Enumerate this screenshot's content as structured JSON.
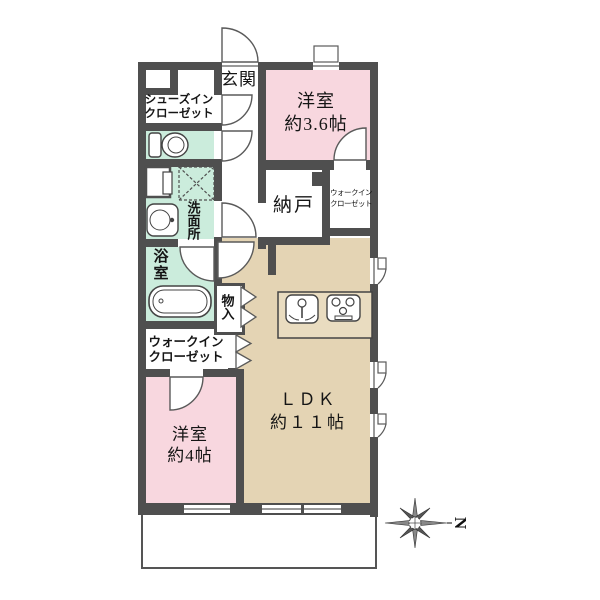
{
  "title": "apartment-floorplan",
  "rooms": {
    "genkan": {
      "label": "玄関"
    },
    "shoes_in_closet": {
      "line1": "シューズイン",
      "line2": "クローゼット"
    },
    "washroom": {
      "label": "洗面所"
    },
    "bathroom": {
      "label": "浴室"
    },
    "storage_monoire": {
      "label": "物入"
    },
    "walkin_closet_left": {
      "line1": "ウォークイン",
      "line2": "クローゼット"
    },
    "bedroom_4": {
      "line1": "洋室",
      "line2": "約4帖"
    },
    "bedroom_36": {
      "line1": "洋室",
      "line2": "約3.6帖"
    },
    "nando": {
      "label": "納戸"
    },
    "walkin_closet_right": {
      "line1": "ウォークイン",
      "line2": "クローゼット"
    },
    "ldk": {
      "line1": "ＬＤＫ",
      "line2": "約１１帖"
    }
  },
  "compass": {
    "label": "N",
    "direction": "north-points-right"
  },
  "colors": {
    "wall": "#4f4f4f",
    "bedroom_pink": "#f8d7df",
    "ldk_beige": "#e4d4b4",
    "wet_area_mint": "#cbecdc",
    "floor_white": "#ffffff"
  }
}
